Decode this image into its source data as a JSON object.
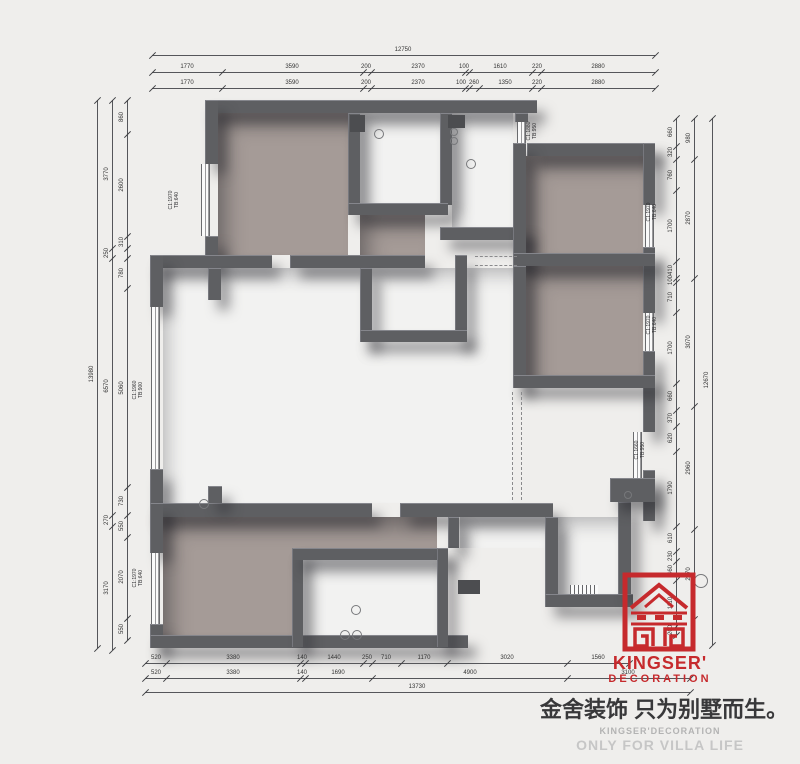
{
  "brand": {
    "name": "KINGSER'",
    "subtitle": "DECORATION",
    "tagline_cn": "金舍装饰 只为别墅而生。",
    "footer_line1": "KINGSER'DECORATION",
    "footer_line2": "ONLY FOR VILLA LIFE",
    "accent_color": "#C62A2D"
  },
  "colors": {
    "wall": "#5E5F62",
    "room_fill": "#A59B97",
    "background": "#EFEEEC"
  },
  "window_labels": [
    {
      "x": 174,
      "y": 200,
      "line1": "C1:1970",
      "line2": "TB:640"
    },
    {
      "x": 138,
      "y": 390,
      "line1": "C1:1960",
      "line2": "TB:900"
    },
    {
      "x": 138,
      "y": 578,
      "line1": "C1:1970",
      "line2": "TB:640"
    },
    {
      "x": 532,
      "y": 131,
      "line1": "C1:1880",
      "line2": "TB:950"
    },
    {
      "x": 652,
      "y": 212,
      "line1": "C1:1970",
      "line2": "TB:640"
    },
    {
      "x": 652,
      "y": 325,
      "line1": "C1:1970",
      "line2": "TB:640"
    },
    {
      "x": 640,
      "y": 450,
      "line1": "C1:1660",
      "line2": "TB:950"
    }
  ],
  "walls": [
    [
      205,
      100,
      332,
      13
    ],
    [
      205,
      100,
      13,
      64
    ],
    [
      205,
      236,
      13,
      32
    ],
    [
      348,
      113,
      12,
      92
    ],
    [
      440,
      113,
      12,
      92
    ],
    [
      348,
      203,
      100,
      12
    ],
    [
      440,
      227,
      85,
      13
    ],
    [
      513,
      227,
      13,
      39
    ],
    [
      515,
      113,
      13,
      9
    ],
    [
      527,
      143,
      128,
      13
    ],
    [
      643,
      143,
      12,
      62
    ],
    [
      643,
      247,
      12,
      66
    ],
    [
      643,
      351,
      12,
      81
    ],
    [
      643,
      470,
      12,
      51
    ],
    [
      513,
      143,
      13,
      122
    ],
    [
      513,
      253,
      142,
      13
    ],
    [
      513,
      266,
      13,
      121
    ],
    [
      513,
      375,
      142,
      13
    ],
    [
      150,
      255,
      122,
      13
    ],
    [
      290,
      255,
      135,
      13
    ],
    [
      150,
      255,
      13,
      52
    ],
    [
      150,
      469,
      13,
      47
    ],
    [
      208,
      268,
      13,
      32
    ],
    [
      360,
      268,
      12,
      74
    ],
    [
      455,
      255,
      12,
      87
    ],
    [
      360,
      330,
      107,
      12
    ],
    [
      150,
      503,
      222,
      14
    ],
    [
      400,
      503,
      153,
      14
    ],
    [
      208,
      486,
      14,
      17
    ],
    [
      448,
      517,
      11,
      31
    ],
    [
      150,
      503,
      13,
      50
    ],
    [
      150,
      624,
      13,
      24
    ],
    [
      150,
      635,
      318,
      13
    ],
    [
      292,
      548,
      11,
      99
    ],
    [
      292,
      548,
      156,
      12
    ],
    [
      437,
      548,
      11,
      99
    ],
    [
      545,
      517,
      13,
      77
    ],
    [
      545,
      594,
      88,
      13
    ],
    [
      618,
      502,
      13,
      92
    ],
    [
      610,
      478,
      45,
      24
    ]
  ],
  "rooms": [
    [
      218,
      113,
      130,
      142,
      "taupe"
    ],
    [
      360,
      215,
      65,
      40,
      "taupe"
    ],
    [
      526,
      156,
      117,
      97,
      "taupe"
    ],
    [
      526,
      266,
      117,
      109,
      "taupe"
    ],
    [
      163,
      517,
      274,
      118,
      "taupe"
    ],
    [
      360,
      113,
      80,
      90,
      "white"
    ],
    [
      452,
      113,
      61,
      114,
      "white"
    ],
    [
      372,
      268,
      83,
      62,
      "white"
    ],
    [
      163,
      268,
      350,
      235,
      "white"
    ],
    [
      303,
      560,
      134,
      75,
      "white"
    ],
    [
      558,
      517,
      60,
      77,
      "white"
    ],
    [
      460,
      517,
      85,
      31,
      "white"
    ]
  ],
  "windows": [
    [
      201,
      164,
      9,
      72
    ],
    [
      151,
      307,
      9,
      162
    ],
    [
      151,
      553,
      9,
      71
    ],
    [
      517,
      122,
      9,
      21
    ],
    [
      645,
      205,
      9,
      42
    ],
    [
      645,
      313,
      9,
      38
    ],
    [
      633,
      432,
      9,
      46
    ]
  ],
  "hatch": [
    570,
    585,
    28,
    9
  ],
  "dashes": [
    [
      475,
      256,
      42,
      "h"
    ],
    [
      475,
      265,
      42,
      "h"
    ],
    [
      512,
      392,
      108,
      "v"
    ],
    [
      521,
      392,
      108,
      "v"
    ]
  ],
  "circles": [
    [
      378,
      133,
      4
    ],
    [
      470,
      163,
      4
    ],
    [
      453,
      131,
      3
    ],
    [
      453,
      140,
      3
    ],
    [
      203,
      503,
      4
    ],
    [
      355,
      609,
      4
    ],
    [
      344,
      634,
      4
    ],
    [
      356,
      634,
      4
    ],
    [
      627,
      494,
      3
    ],
    [
      700,
      580,
      6
    ]
  ],
  "squares": [
    [
      350,
      115,
      15,
      17
    ],
    [
      448,
      115,
      17,
      13
    ],
    [
      458,
      580,
      22,
      14
    ]
  ],
  "dims": [
    {
      "o": "h",
      "p": 55,
      "a": 152,
      "b": 655,
      "cuts": [
        152,
        655
      ],
      "labels": [
        [
          "12750",
          403
        ]
      ]
    },
    {
      "o": "h",
      "p": 72,
      "a": 152,
      "b": 655,
      "cuts": [
        152,
        222,
        363,
        371,
        465,
        469,
        532,
        541,
        655
      ],
      "labels": [
        [
          "1770",
          187
        ],
        [
          "3590",
          292
        ],
        [
          "200",
          366
        ],
        [
          "2370",
          418
        ],
        [
          "100",
          464
        ],
        [
          "1610",
          500
        ],
        [
          "220",
          537
        ],
        [
          "2880",
          598
        ]
      ]
    },
    {
      "o": "h",
      "p": 88,
      "a": 152,
      "b": 655,
      "cuts": [
        152,
        222,
        363,
        371,
        465,
        469,
        479,
        532,
        541,
        655
      ],
      "labels": [
        [
          "1770",
          187
        ],
        [
          "3590",
          292
        ],
        [
          "200",
          366
        ],
        [
          "2370",
          418
        ],
        [
          "100",
          461
        ],
        [
          "260",
          474
        ],
        [
          "1350",
          505
        ],
        [
          "220",
          537
        ],
        [
          "2880",
          598
        ]
      ]
    },
    {
      "o": "h",
      "p": 663,
      "a": 145,
      "b": 629,
      "cuts": [
        145,
        166,
        300,
        305,
        363,
        372,
        401,
        447,
        567,
        629
      ],
      "labels": [
        [
          "520",
          156
        ],
        [
          "3380",
          233
        ],
        [
          "140",
          302
        ],
        [
          "1440",
          334
        ],
        [
          "250",
          367
        ],
        [
          "710",
          386
        ],
        [
          "1170",
          424
        ],
        [
          "3020",
          507
        ],
        [
          "1560",
          598
        ]
      ]
    },
    {
      "o": "h",
      "p": 678,
      "a": 145,
      "b": 690,
      "cuts": [
        145,
        166,
        300,
        305,
        372,
        567,
        690
      ],
      "labels": [
        [
          "520",
          156
        ],
        [
          "3380",
          233
        ],
        [
          "140",
          302
        ],
        [
          "1690",
          338
        ],
        [
          "4900",
          470
        ],
        [
          "3100",
          628
        ]
      ]
    },
    {
      "o": "h",
      "p": 692,
      "a": 145,
      "b": 690,
      "cuts": [
        145,
        690
      ],
      "labels": [
        [
          "13730",
          417
        ]
      ]
    },
    {
      "o": "v",
      "p": 97,
      "a": 100,
      "b": 648,
      "cuts": [
        100,
        648
      ],
      "labels": [
        [
          "13980",
          374
        ]
      ]
    },
    {
      "o": "v",
      "p": 112,
      "a": 100,
      "b": 650,
      "cuts": [
        100,
        248,
        258,
        515,
        526,
        650
      ],
      "labels": [
        [
          "3770",
          174
        ],
        [
          "250",
          253
        ],
        [
          "6570",
          386
        ],
        [
          "270",
          520
        ],
        [
          "3170",
          588
        ]
      ]
    },
    {
      "o": "v",
      "p": 127,
      "a": 100,
      "b": 640,
      "cuts": [
        100,
        134,
        236,
        248,
        258,
        288,
        487,
        515,
        537,
        618,
        640
      ],
      "labels": [
        [
          "860",
          117
        ],
        [
          "2600",
          185
        ],
        [
          "310",
          242
        ],
        [
          "780",
          273
        ],
        [
          "5060",
          388
        ],
        [
          "730",
          501
        ],
        [
          "550",
          526
        ],
        [
          "2070",
          577
        ],
        [
          "550",
          629
        ]
      ]
    },
    {
      "o": "v",
      "p": 712,
      "a": 118,
      "b": 645,
      "cuts": [
        118,
        645
      ],
      "labels": [
        [
          "12670",
          380
        ]
      ]
    },
    {
      "o": "v",
      "p": 694,
      "a": 118,
      "b": 619,
      "cuts": [
        118,
        159,
        278,
        406,
        529,
        619
      ],
      "labels": [
        [
          "980",
          138
        ],
        [
          "2870",
          218
        ],
        [
          "3070",
          342
        ],
        [
          "2960",
          468
        ],
        [
          "2170",
          574
        ]
      ]
    },
    {
      "o": "v",
      "p": 676,
      "a": 118,
      "b": 635,
      "cuts": [
        118,
        146,
        159,
        190,
        261,
        278,
        282,
        312,
        383,
        410,
        426,
        451,
        526,
        551,
        561,
        580,
        626,
        635
      ],
      "labels": [
        [
          "660",
          132
        ],
        [
          "320",
          152
        ],
        [
          "760",
          175
        ],
        [
          "1700",
          226
        ],
        [
          "410",
          270
        ],
        [
          "100",
          280
        ],
        [
          "710",
          297
        ],
        [
          "1700",
          348
        ],
        [
          "660",
          396
        ],
        [
          "370",
          418
        ],
        [
          "620",
          438
        ],
        [
          "1790",
          488
        ],
        [
          "610",
          538
        ],
        [
          "230",
          556
        ],
        [
          "460",
          570
        ],
        [
          "1110",
          603
        ],
        [
          "200",
          630
        ]
      ]
    }
  ]
}
